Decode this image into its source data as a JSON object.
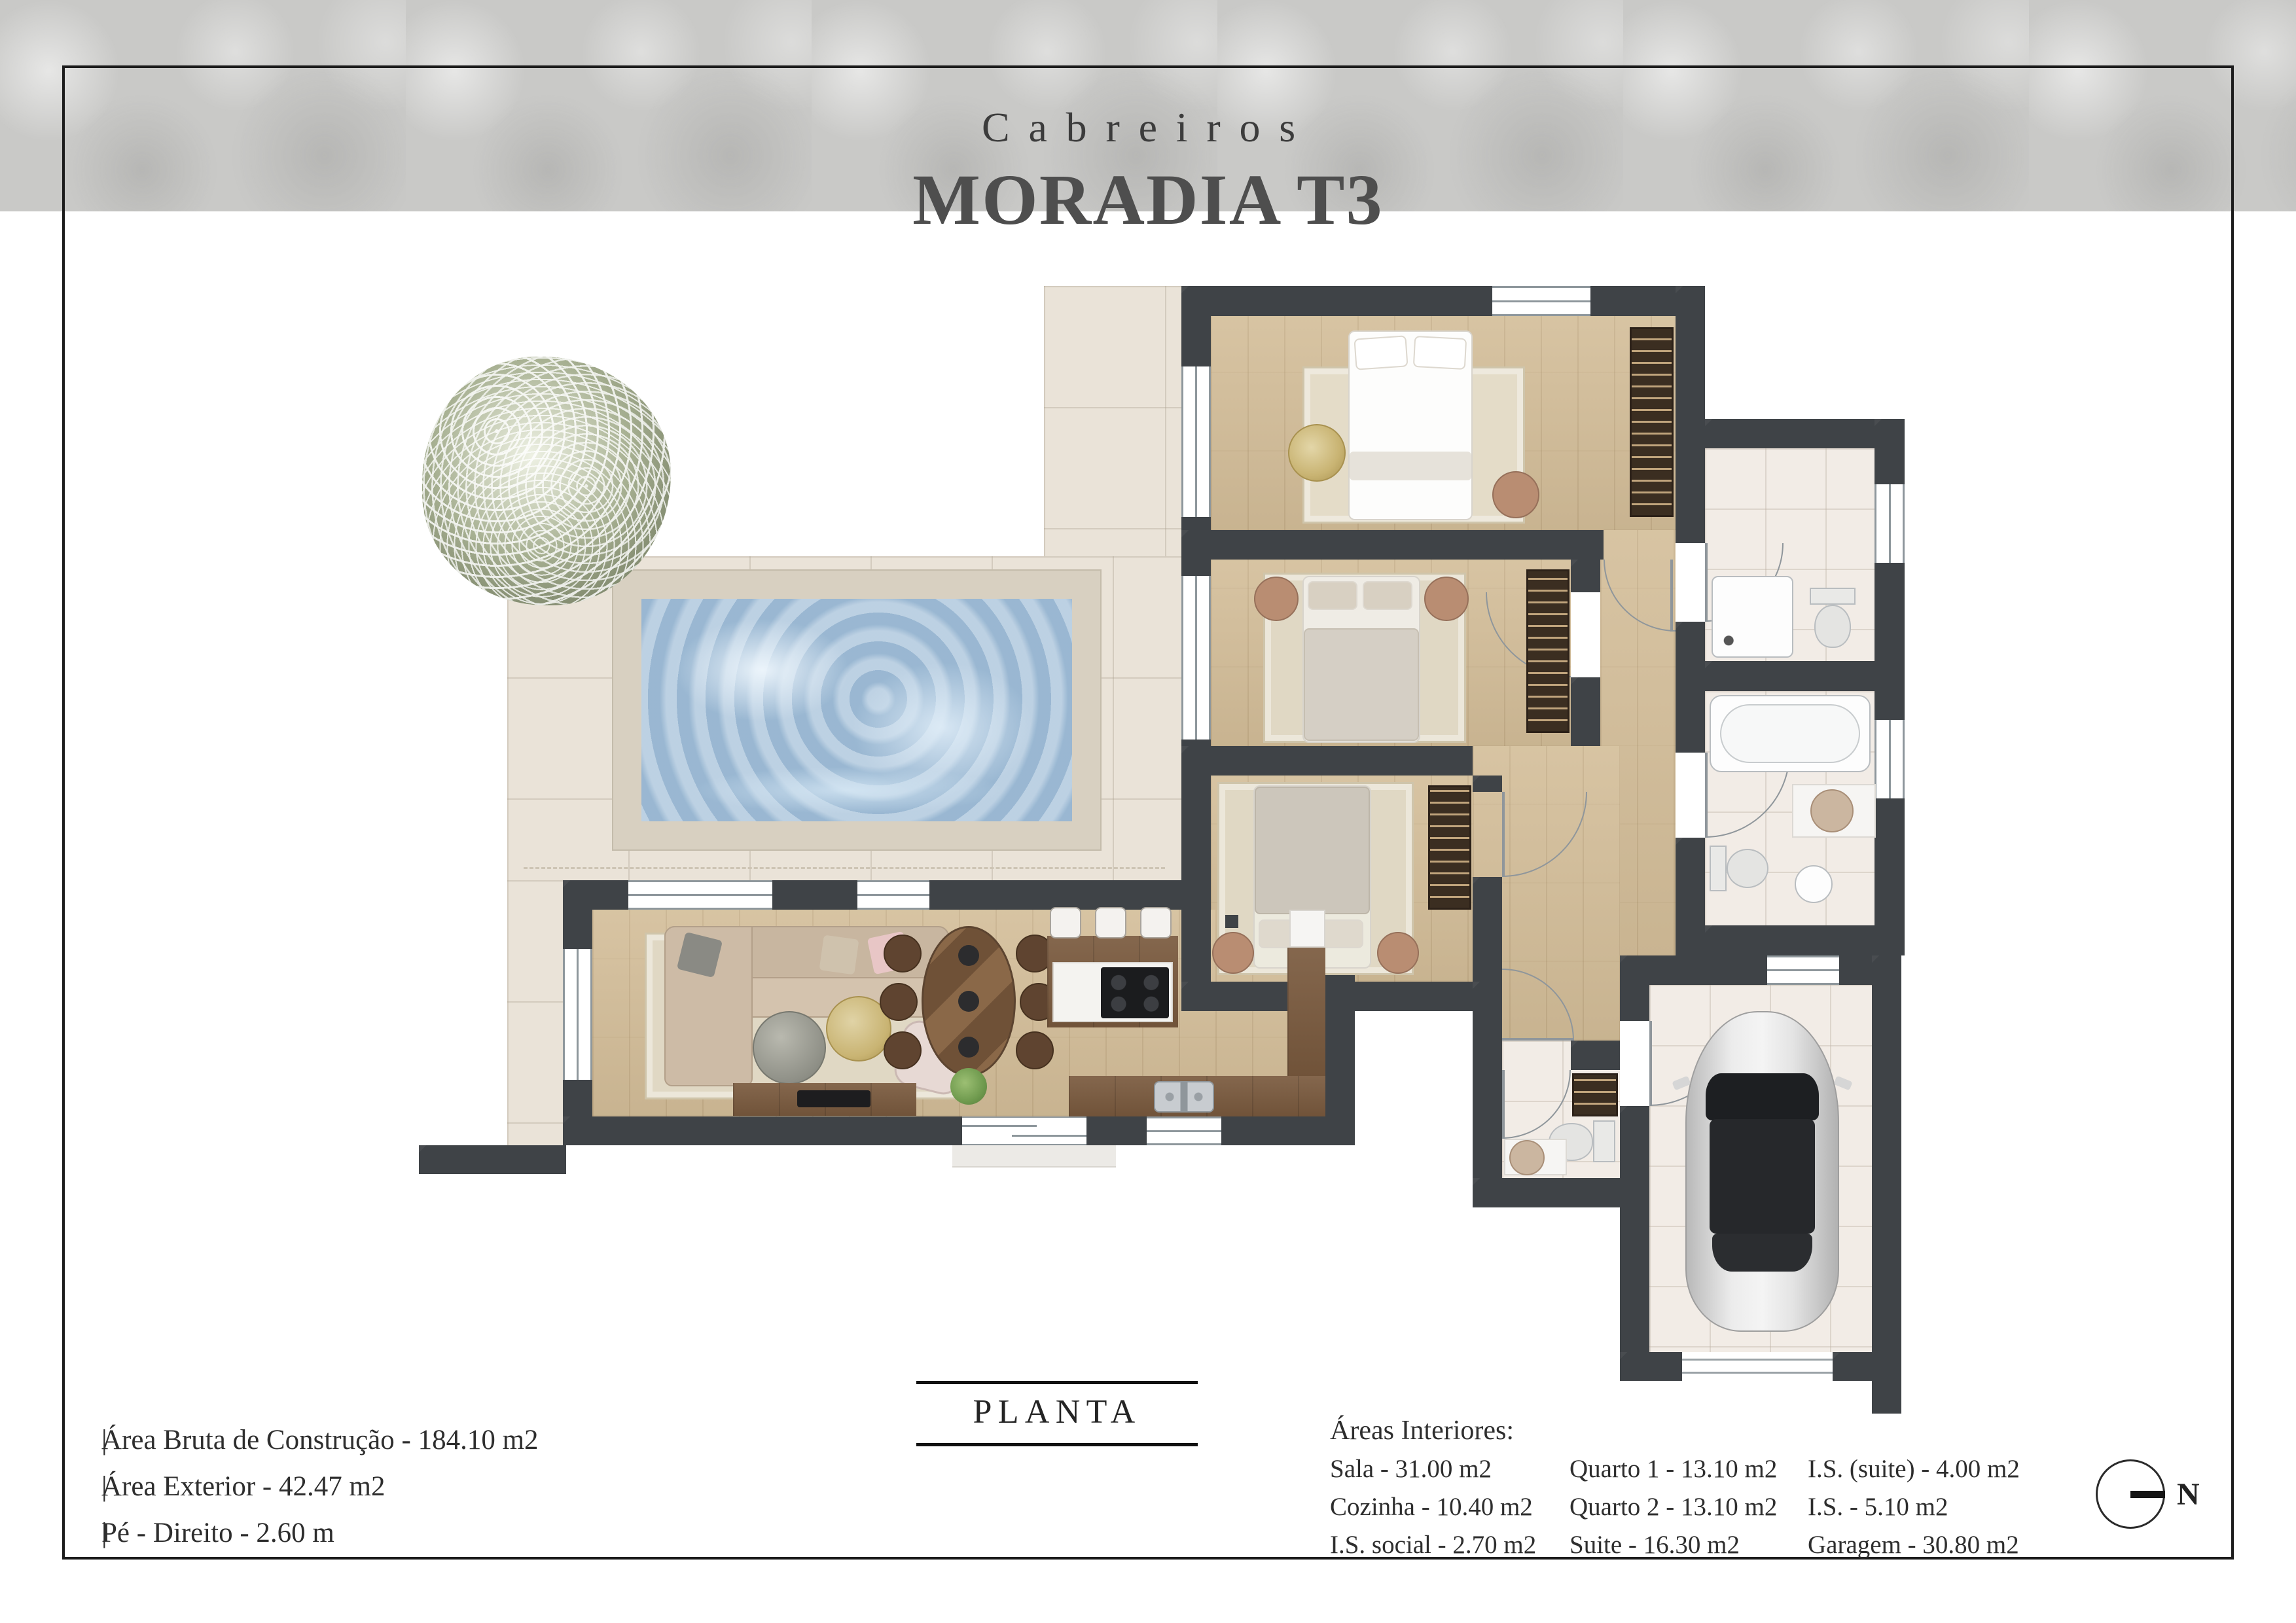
{
  "header": {
    "brand": "Cabreiros",
    "title": "MORADIA T3"
  },
  "plan_label": "PLANTA",
  "specs": [
    {
      "prefix": "|",
      "text": "Área Bruta de Construção - 184.10 m2"
    },
    {
      "prefix": "|",
      "text": "Área Exterior - 42.47 m2"
    },
    {
      "prefix": "|",
      "text": "Pé - Direito - 2.60 m"
    }
  ],
  "areas": {
    "title": "Áreas Interiores:",
    "col1": [
      "Sala - 31.00 m2",
      "Cozinha - 10.40 m2",
      "I.S. social - 2.70 m2"
    ],
    "col2": [
      "Quarto 1 - 13.10 m2",
      "Quarto 2 - 13.10 m2",
      "Suite - 16.30 m2"
    ],
    "col3": [
      "I.S. (suite) - 4.00 m2",
      "I.S. - 5.10 m2",
      "Garagem - 30.80 m2"
    ]
  },
  "compass": {
    "label": "N"
  },
  "colors": {
    "wall": "#3f4347",
    "wood": "#d3bd98",
    "patio_tile": "#eae3d8",
    "bath_tile": "#f2ece6",
    "pool_water": "#a3bfd8",
    "pool_deck": "#d8d0c1",
    "marble_band": "#c9c9c7",
    "text": "#2e2e2e",
    "cabinet_wood": "#7a5a3e"
  }
}
